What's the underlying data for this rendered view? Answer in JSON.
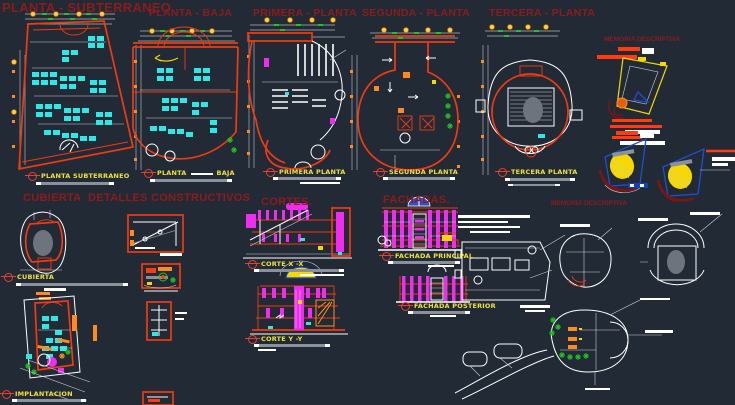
{
  "app": {
    "name": "cad-architectural-drawing-sheet",
    "background": "#222a35"
  },
  "palette": {
    "bg": "#222a35",
    "titlered": "#8c1c1c",
    "labyellow": "#eee23c",
    "red": "#f13a10",
    "orange": "#ff8b1f",
    "cyan": "#2ee8e8",
    "magenta": "#f02cf0",
    "green": "#1ec420",
    "blue": "#1d4fd0",
    "yellow": "#f5d800",
    "gray": "#8a919b",
    "lightgray": "#c9ced6",
    "white": "#ffffff",
    "darkred": "#7e1515",
    "bubble": "#ffd23e",
    "ovalgray": "#6e747d",
    "redorange": "#ff3c0e"
  },
  "titles": {
    "planta_subterraneo": "PLANTA - SUBTERRANEO",
    "planta_baja": "PLANTA - BAJA",
    "primera_planta": "PRIMERA - PLANTA",
    "segunda_planta": "SEGUNDA - PLANTA",
    "tercera_planta": "TERCERA - PLANTA",
    "memoria_descriptiva_right": "MEMORIA DESCRIPTIVA",
    "cubierta": "CUBIERTA",
    "detalles_constructivos": "DETALLES CONSTRUCTIVOS",
    "cortes": "CORTES.",
    "fachadas": "FACHADAS.",
    "memoria_descriptiva_center": "MEMORIA DESCRIPTIVA"
  },
  "sheet_labels": {
    "planta_subterraneo": "PLANTA SUBTERRANEO",
    "planta_baja_left": "PLANTA",
    "planta_baja_right": "BAJA",
    "primera_planta": "PRIMERA PLANTA",
    "segunda_planta": "SEGUNDA PLANTA",
    "tercera_planta": "TERCERA PLANTA",
    "cubierta": "CUBIERTA",
    "corte_x": "CORTE X -X",
    "corte_y": "CORTE Y -Y",
    "fachada_principal": "FACHADA PRINCIPAL",
    "fachada_posterior": "FACHADA POSTERIOR",
    "implantacion": "IMPLANTACION"
  }
}
